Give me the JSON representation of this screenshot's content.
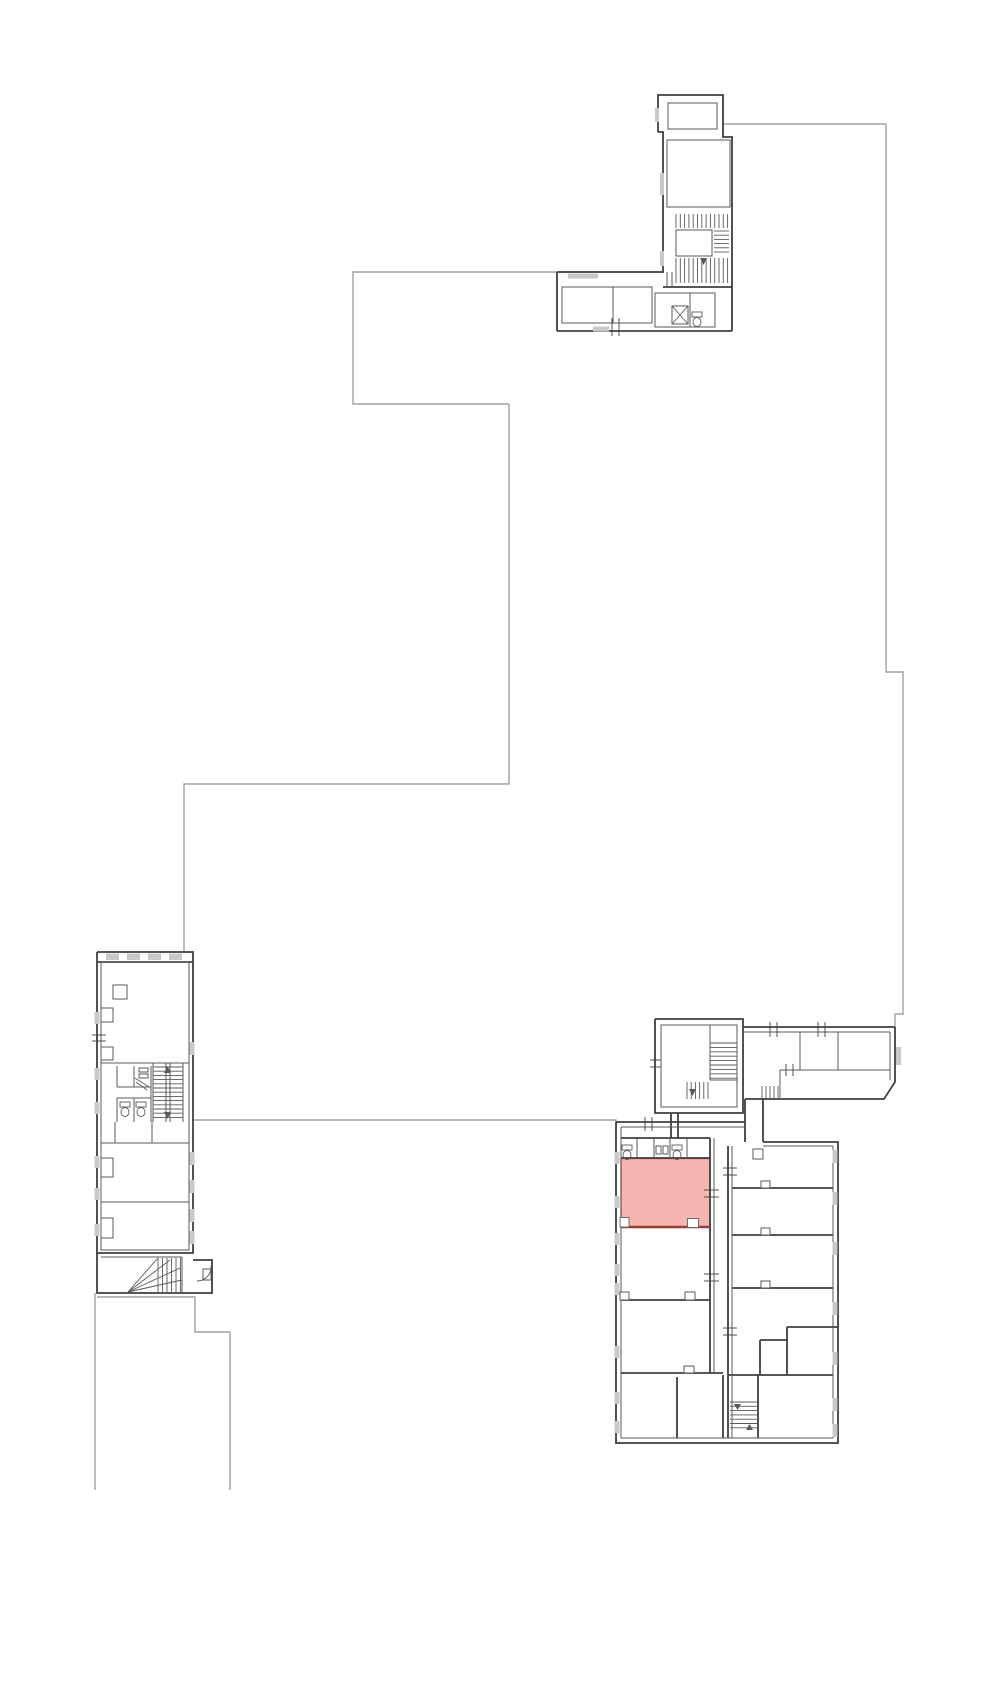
{
  "canvas": {
    "width": 1000,
    "height": 1690,
    "background": "#ffffff"
  },
  "palette": {
    "boundary": "#8f8f8f",
    "wall": "#3f3f3f",
    "wall_light": "#5a5a5a",
    "window": "#c9c9c9",
    "highlight_fill": "#f7b5b1",
    "highlight_stroke": "#b5483f",
    "highlight_bottom": "#993d36",
    "notch_fill": "#ffffff"
  },
  "highlight_room": {
    "x": 621,
    "y": 1158.5,
    "width": 89,
    "height": 68.5,
    "bottom_edge": "M621,1227 L710,1227",
    "notches": [
      {
        "x": 620,
        "y": 1217.5,
        "w": 9,
        "h": 9.5
      },
      {
        "x": 687.5,
        "y": 1218.5,
        "w": 11,
        "h": 9
      }
    ]
  },
  "boundaries": [
    "M557,272 L353,272 L353,404 L509,404",
    "M509,404 L509,784 L184,784 L184,952",
    "M723,124 L886,124",
    "M886,124 L886,672 L903,672 L903,1014 L895,1014 L895,1027",
    "M193,1120 L616,1120 L616,1124",
    "M95,1293 L95,1490",
    "M97,1297 L195,1297 L195,1332 L230,1332 L230,1490"
  ],
  "walls_main": [
    "M658,132 L658,95 L723,95 L723,123",
    "M723,123 L723,137 L732,137 L732,331",
    "M658,132 L663,132 L663,273",
    "M557,272 L557,331",
    "M557,272 L663,272",
    "M557,331 L732,331",
    "M663,287 L732,287",
    "M97,952 L193,952 L193,1253 L97,1253 L97,952",
    "M97,962 L193,962",
    "M97,1253 L97,1293 L212,1293 L212,1260 L193,1260",
    "M655,1019 L743,1019 L743,1113 L655,1113 L655,1019",
    "M743,1027 L895,1027",
    "M895,1027 L895,1082 L884,1099 L745,1099",
    "M745,1099 L745,1142",
    "M763,1099 L763,1142",
    "M616,1122 L616,1443 L838,1443 L838,1142 L763,1142",
    "M616,1122 L745,1122",
    "M621,1138 L710,1138",
    "M621,1158 L710,1158",
    "M710,1138 L710,1373",
    "M728,1146 L728,1438",
    "M621,1300 L710,1300",
    "M621,1373 L723,1373",
    "M677,1377 L677,1438",
    "M723,1375 L723,1438",
    "M728,1375 L833,1375",
    "M758,1375 L758,1438",
    "M732,1188 L833,1188",
    "M732,1235 L833,1235",
    "M732,1288 L833,1288",
    "M787,1327 L838,1327",
    "M787,1327 L787,1375",
    "M760,1340 L787,1340",
    "M760,1340 L760,1375",
    "M671,1113 L671,1138",
    "M678,1113 L678,1138"
  ],
  "walls_inner": [
    "M690,293 L690,327",
    "M715,293 L715,327",
    "M667,272 L667,287",
    "M672,272 L672,287",
    "M743,1032 L890,1032",
    "M890,1032 L890,1080",
    "M800,1032 L800,1070",
    "M838,1032 L838,1070",
    "M780,1070 L890,1070",
    "M780,1070 L780,1099",
    "M710,1025 L710,1080",
    "M710,1080 L737,1080",
    "M621,1127 L745,1127",
    "M621,1127 L621,1438",
    "M621,1438 L833,1438",
    "M833,1146 L833,1438",
    "M763,1146 L833,1146",
    "M714,1138 L714,1373",
    "M732,1146 L732,1438",
    "M637,1138 L637,1158",
    "M654,1138 L654,1158",
    "M670,1138 L670,1158",
    "M687,1138 L687,1158",
    "M101,1063 L189,1063",
    "M101,1143 L189,1143",
    "M101,1202 L189,1202",
    "M101,1250 L189,1250",
    "M117,1066 L117,1087",
    "M117,1087 L151,1087",
    "M134,1066 L134,1087",
    "M151,1066 L151,1122",
    "M117,1098 L151,1098",
    "M117,1098 L117,1122",
    "M134,1098 L134,1122",
    "M115,1122 L115,1143",
    "M152,1122 L152,1143",
    "M153,1063 L153,1122",
    "M183,1063 L183,1122",
    "M166,1063 L166,1122",
    "M170,1063 L170,1122",
    "M101,1257 L182,1257",
    "M182,1257 L182,1293"
  ],
  "rooms": [
    {
      "name": "room-outline",
      "x": 668,
      "y": 103,
      "w": 49,
      "h": 26
    },
    {
      "name": "room-outline",
      "x": 667,
      "y": 140,
      "w": 63,
      "h": 67
    },
    {
      "name": "stair-landing",
      "x": 676,
      "y": 230,
      "w": 36,
      "h": 26
    },
    {
      "name": "room-outline",
      "x": 562,
      "y": 287,
      "w": 51,
      "h": 36
    },
    {
      "name": "room-outline",
      "x": 613,
      "y": 287,
      "w": 39,
      "h": 36
    },
    {
      "name": "room-outline",
      "x": 655,
      "y": 293,
      "w": 60,
      "h": 34
    },
    {
      "name": "stair-tower-inner",
      "x": 661,
      "y": 1025,
      "w": 76,
      "h": 82
    },
    {
      "name": "left-building-inner",
      "x": 101,
      "y": 962,
      "w": 88,
      "h": 288
    },
    {
      "name": "elevator-shaft",
      "x": 672,
      "y": 306,
      "w": 16,
      "h": 18
    },
    {
      "name": "column",
      "x": 113,
      "y": 985,
      "w": 14,
      "h": 14
    },
    {
      "name": "column",
      "x": 753,
      "y": 1149,
      "w": 10,
      "h": 10
    },
    {
      "name": "door-leaf",
      "x": 203,
      "y": 1269,
      "w": 8,
      "h": 11
    },
    {
      "name": "fixture-mark",
      "x": 656,
      "y": 1146,
      "w": 5,
      "h": 8
    },
    {
      "name": "fixture-mark",
      "x": 663,
      "y": 1146,
      "w": 5,
      "h": 8
    },
    {
      "name": "sink-fixture",
      "x": 139,
      "y": 1068,
      "w": 9,
      "h": 4
    },
    {
      "name": "sink-fixture",
      "x": 139,
      "y": 1074,
      "w": 9,
      "h": 4
    },
    {
      "name": "wall-pilaster",
      "x": 101,
      "y": 1008,
      "w": 12,
      "h": 14
    },
    {
      "name": "wall-pilaster",
      "x": 101,
      "y": 1047,
      "w": 12,
      "h": 13
    },
    {
      "name": "wall-pilaster",
      "x": 101,
      "y": 1158,
      "w": 12,
      "h": 19
    },
    {
      "name": "wall-pilaster",
      "x": 101,
      "y": 1218,
      "w": 12,
      "h": 20
    },
    {
      "name": "door-notch",
      "x": 761,
      "y": 1181,
      "w": 9,
      "h": 7,
      "fill": "#ffffff"
    },
    {
      "name": "door-notch",
      "x": 761,
      "y": 1228,
      "w": 9,
      "h": 7,
      "fill": "#ffffff"
    },
    {
      "name": "door-notch",
      "x": 761,
      "y": 1281,
      "w": 9,
      "h": 7,
      "fill": "#ffffff"
    },
    {
      "name": "pillar-notch",
      "x": 620,
      "y": 1292,
      "w": 9,
      "h": 8,
      "fill": "#ffffff"
    },
    {
      "name": "pillar-notch",
      "x": 685,
      "y": 1292,
      "w": 10,
      "h": 8,
      "fill": "#ffffff"
    },
    {
      "name": "pillar-notch",
      "x": 684,
      "y": 1366,
      "w": 10,
      "h": 7,
      "fill": "#ffffff"
    }
  ],
  "windows": [
    {
      "x": 655,
      "y": 108,
      "w": 4,
      "h": 14
    },
    {
      "x": 660,
      "y": 173,
      "w": 4,
      "h": 22
    },
    {
      "x": 660,
      "y": 251,
      "w": 4,
      "h": 15
    },
    {
      "x": 568,
      "y": 273.5,
      "w": 30,
      "h": 5
    },
    {
      "x": 593,
      "y": 326.5,
      "w": 16,
      "h": 5
    },
    {
      "x": 896,
      "y": 1047,
      "w": 5,
      "h": 18
    },
    {
      "x": 614.5,
      "y": 1152,
      "w": 5,
      "h": 12
    },
    {
      "x": 614.5,
      "y": 1196,
      "w": 5,
      "h": 12
    },
    {
      "x": 614.5,
      "y": 1233,
      "w": 5,
      "h": 12
    },
    {
      "x": 614.5,
      "y": 1264,
      "w": 5,
      "h": 12
    },
    {
      "x": 614.5,
      "y": 1283,
      "w": 5,
      "h": 12
    },
    {
      "x": 614.5,
      "y": 1346,
      "w": 5,
      "h": 12
    },
    {
      "x": 614.5,
      "y": 1392,
      "w": 5,
      "h": 12
    },
    {
      "x": 614.5,
      "y": 1421,
      "w": 5,
      "h": 12
    },
    {
      "x": 832.5,
      "y": 1150,
      "w": 5,
      "h": 13
    },
    {
      "x": 832.5,
      "y": 1192,
      "w": 5,
      "h": 13
    },
    {
      "x": 832.5,
      "y": 1242,
      "w": 5,
      "h": 13
    },
    {
      "x": 832.5,
      "y": 1302,
      "w": 5,
      "h": 13
    },
    {
      "x": 832.5,
      "y": 1352,
      "w": 5,
      "h": 13
    },
    {
      "x": 832.5,
      "y": 1398,
      "w": 5,
      "h": 13
    },
    {
      "x": 832.5,
      "y": 1424,
      "w": 5,
      "h": 13
    },
    {
      "x": 94.5,
      "y": 1012,
      "w": 5,
      "h": 12
    },
    {
      "x": 94.5,
      "y": 1068,
      "w": 5,
      "h": 12
    },
    {
      "x": 94.5,
      "y": 1102,
      "w": 5,
      "h": 12
    },
    {
      "x": 94.5,
      "y": 1156,
      "w": 5,
      "h": 12
    },
    {
      "x": 94.5,
      "y": 1188,
      "w": 5,
      "h": 12
    },
    {
      "x": 94.5,
      "y": 1224,
      "w": 5,
      "h": 12
    },
    {
      "x": 189.5,
      "y": 1042,
      "w": 5,
      "h": 13
    },
    {
      "x": 189.5,
      "y": 1152,
      "w": 5,
      "h": 13
    },
    {
      "x": 189.5,
      "y": 1180,
      "w": 5,
      "h": 13
    },
    {
      "x": 189.5,
      "y": 1209,
      "w": 5,
      "h": 13
    },
    {
      "x": 189.5,
      "y": 1231,
      "w": 5,
      "h": 13
    },
    {
      "x": 106,
      "y": 953.5,
      "w": 13,
      "h": 6.5
    },
    {
      "x": 127,
      "y": 953.5,
      "w": 13,
      "h": 6.5
    },
    {
      "x": 148,
      "y": 953.5,
      "w": 13,
      "h": 6.5
    },
    {
      "x": 169,
      "y": 953.5,
      "w": 13,
      "h": 6.5
    }
  ],
  "stairs": [
    {
      "x": 676,
      "y": 214,
      "w": 52,
      "h": 14,
      "dir": "v",
      "step": 4.3
    },
    {
      "x": 676,
      "y": 258,
      "w": 52,
      "h": 25,
      "dir": "v",
      "step": 4.3
    },
    {
      "x": 714,
      "y": 231,
      "w": 15,
      "h": 25,
      "dir": "h",
      "step": 4.2
    },
    {
      "x": 153,
      "y": 1067,
      "w": 30,
      "h": 54,
      "dir": "h",
      "step": 4.2
    },
    {
      "x": 710,
      "y": 1043,
      "w": 27,
      "h": 37,
      "dir": "h",
      "step": 4.4
    },
    {
      "x": 687,
      "y": 1082,
      "w": 23,
      "h": 17,
      "dir": "v",
      "step": 4.2
    },
    {
      "x": 762,
      "y": 1086,
      "w": 18,
      "h": 12,
      "dir": "v",
      "step": 4.0
    },
    {
      "x": 730,
      "y": 1402,
      "w": 27,
      "h": 30,
      "dir": "h",
      "step": 4.3
    },
    {
      "x": 158,
      "y": 1258,
      "w": 24,
      "h": 34,
      "dir": "v",
      "step": 4.5
    }
  ],
  "diagonals": [
    "M672,306 L688,324",
    "M688,306 L672,324",
    "M128,1292 L158,1258",
    "M128,1292 L170,1260",
    "M128,1292 L180,1268",
    "M128,1292 L182,1280",
    "M135,1078 L149,1087",
    "M136,1082 L147,1090"
  ],
  "ticks": [
    "M645,1117 L645,1131",
    "M652,1117 L652,1131",
    "M704,1190 L719,1190",
    "M704,1197 L719,1197",
    "M704,1274 L719,1274",
    "M704,1281 L719,1281",
    "M723,1168 L737,1168",
    "M723,1175 L737,1175",
    "M723,1328 L737,1328",
    "M723,1335 L737,1335",
    "M770,1022 L770,1037",
    "M777,1022 L777,1037",
    "M818,1022 L818,1037",
    "M825,1022 L825,1037",
    "M786,1064 L786,1076",
    "M793,1064 L793,1076",
    "M612,318 L612,336",
    "M619,318 L619,336",
    "M650,1060 L661,1060",
    "M650,1067 L661,1067",
    "M92,1035 L106,1035",
    "M92,1041 L106,1041"
  ],
  "fixtures": {
    "toilets": [
      {
        "x": 622,
        "y": 1145
      },
      {
        "x": 672,
        "y": 1145
      },
      {
        "x": 120,
        "y": 1102
      },
      {
        "x": 136,
        "y": 1102
      },
      {
        "x": 692,
        "y": 312
      }
    ],
    "door_arcs": [
      "M197,1281 A14,14 0 0 0 211,1266"
    ],
    "arrows": [
      "164,1073 171,1073 167.5,1066",
      "164,1112 171,1112 167.5,1119",
      "689,1089 696,1089 692.5,1096",
      "734,1404 741,1404 737.5,1410",
      "746,1430 753,1430 749.5,1424",
      "700,258 707,258 703.5,265"
    ]
  }
}
